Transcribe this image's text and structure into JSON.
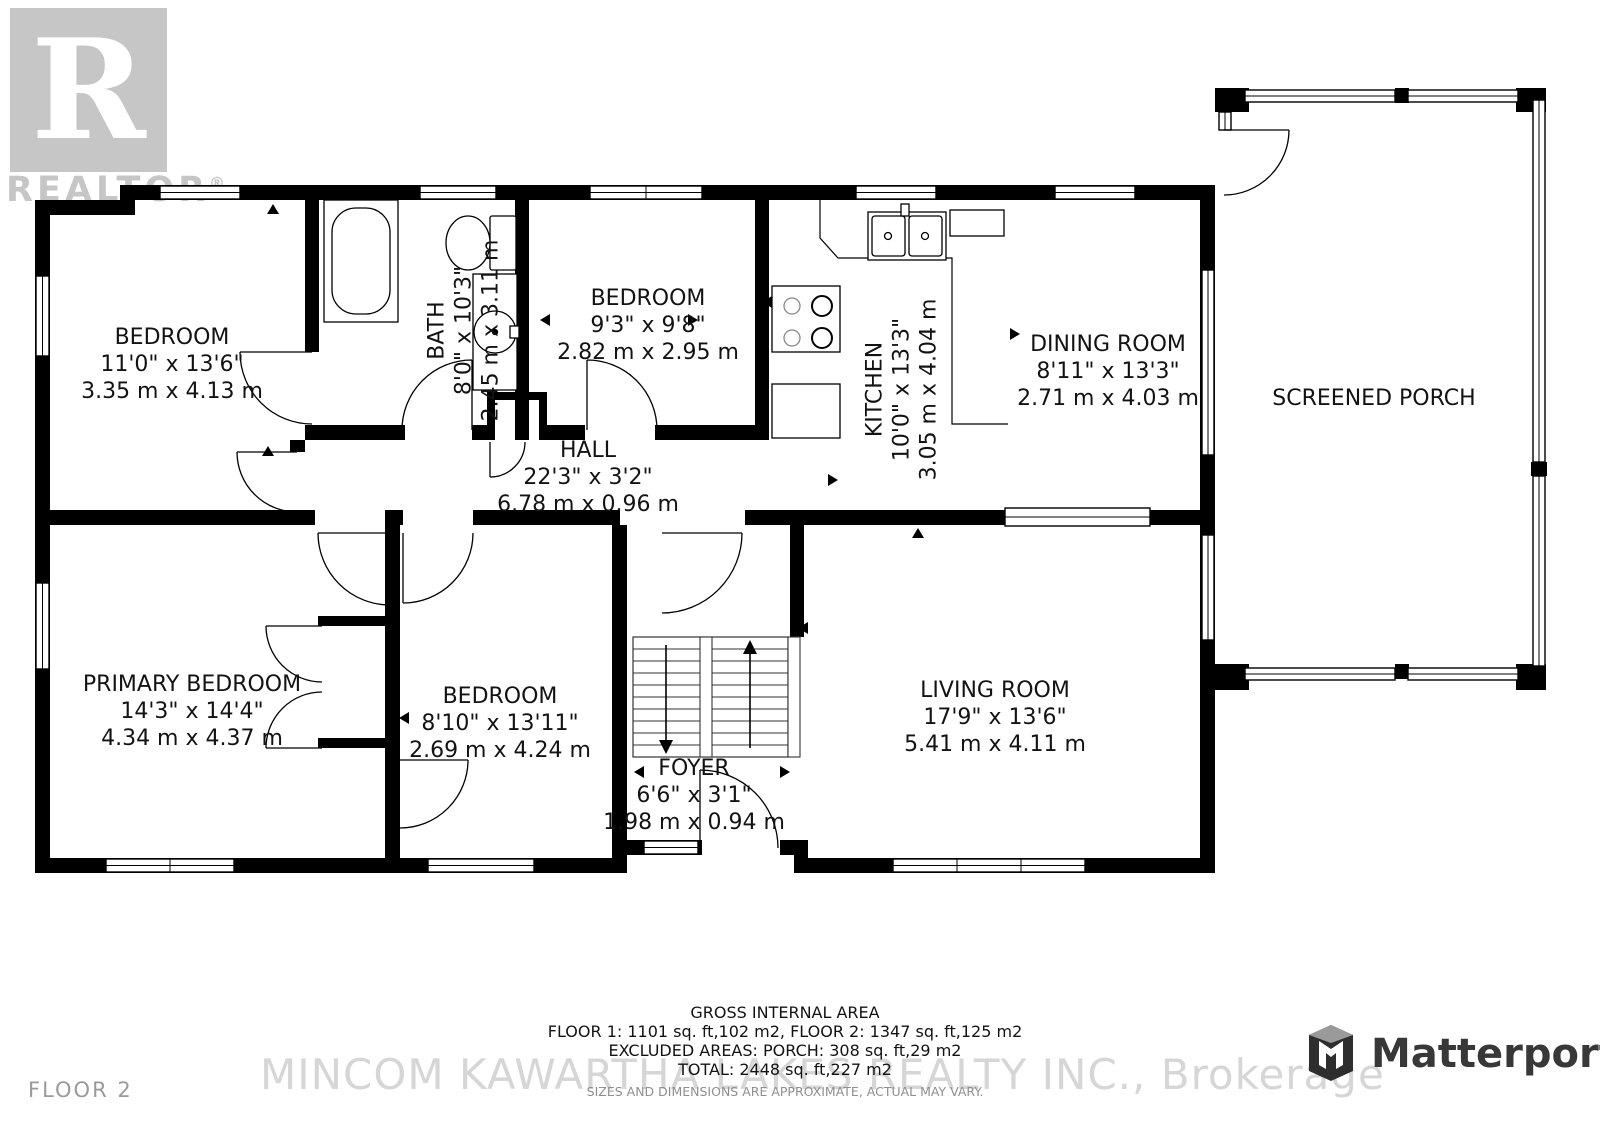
{
  "branding": {
    "realtor_r": "R",
    "realtor_word": "REALTOR",
    "realtor_reg": "®",
    "matterport": "Matterport",
    "floor": "FLOOR 2",
    "watermark": "MINCOM KAWARTHA LAKES REALTY INC., Brokerage"
  },
  "rooms": [
    {
      "id": "bedroom-top-left",
      "name": "BEDROOM",
      "imperial": "11'0\" x 13'6\"",
      "metric": "3.35 m x 4.13 m"
    },
    {
      "id": "bath",
      "name": "BATH",
      "imperial": "8'0\" x 10'3\"",
      "metric": "2.45 m x 3.11 m"
    },
    {
      "id": "bedroom-top",
      "name": "BEDROOM",
      "imperial": "9'3\" x 9'8\"",
      "metric": "2.82 m x 2.95 m"
    },
    {
      "id": "kitchen",
      "name": "KITCHEN",
      "imperial": "10'0\" x 13'3\"",
      "metric": "3.05 m x 4.04 m"
    },
    {
      "id": "dining-room",
      "name": "DINING ROOM",
      "imperial": "8'11\" x 13'3\"",
      "metric": "2.71 m x 4.03 m"
    },
    {
      "id": "screened-porch",
      "name": "SCREENED PORCH"
    },
    {
      "id": "hall",
      "name": "HALL",
      "imperial": "22'3\" x 3'2\"",
      "metric": "6.78 m x 0.96 m"
    },
    {
      "id": "primary-bedroom",
      "name": "PRIMARY BEDROOM",
      "imperial": "14'3\" x 14'4\"",
      "metric": "4.34 m x 4.37 m"
    },
    {
      "id": "bedroom-bottom",
      "name": "BEDROOM",
      "imperial": "8'10\" x 13'11\"",
      "metric": "2.69 m x 4.24 m"
    },
    {
      "id": "foyer",
      "name": "FOYER",
      "imperial": "6'6\" x 3'1\"",
      "metric": "1.98 m x 0.94 m"
    },
    {
      "id": "living-room",
      "name": "LIVING ROOM",
      "imperial": "17'9\" x 13'6\"",
      "metric": "5.41 m x 4.11 m"
    }
  ],
  "summary": {
    "title": "GROSS INTERNAL AREA",
    "line1": "FLOOR 1: 1101 sq. ft,102 m2, FLOOR 2: 1347 sq. ft,125 m2",
    "line2": "EXCLUDED AREAS:  PORCH: 308 sq. ft,29 m2",
    "line3": "TOTAL: 2448 sq. ft,227 m2",
    "disclaimer": "SIZES AND DIMENSIONS ARE APPROXIMATE, ACTUAL MAY VARY."
  },
  "colors": {
    "wall": "#000000",
    "label_text": "#131313",
    "watermark_gray": "#d6d6d6",
    "logo_gray": "#c6c6c6",
    "matterport_dark": "#2e2e2e"
  }
}
